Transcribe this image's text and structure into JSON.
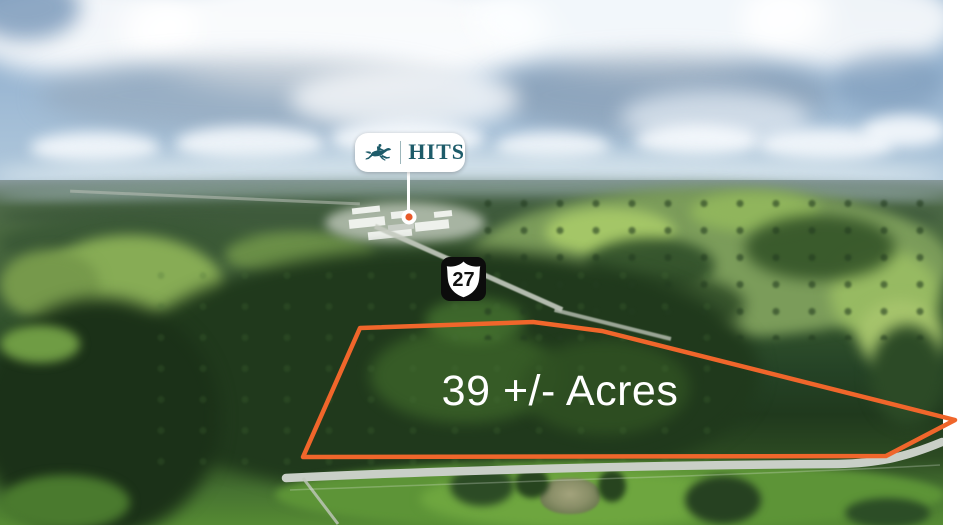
{
  "parcel_overlay": {
    "acreage_label": "39 +/- Acres"
  },
  "location_pin": {
    "brand_name": "HITS",
    "icon": "horse-jumping-icon"
  },
  "highway_shield": {
    "route_number": "27"
  },
  "colors": {
    "boundary_orange": "#F0662B",
    "brand_teal": "#1D5B69",
    "pin_dot_orange": "#E85A2A",
    "pin_white": "#FFFFFF",
    "shield_black": "#0C0C0C",
    "shield_white": "#FFFFFF",
    "label_white": "#FFFFFF",
    "road_gray": "#C9CFC7"
  }
}
